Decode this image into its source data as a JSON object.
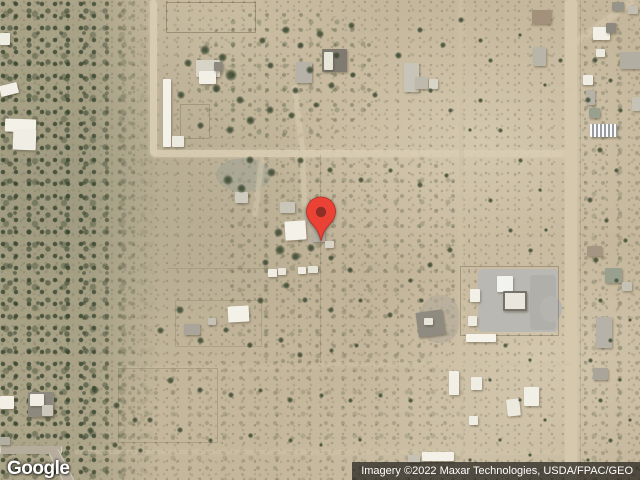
{
  "watermark": {
    "logo_text": "Google"
  },
  "attribution": {
    "text": "Imagery ©2022 Maxar Technologies, USDA/FPAC/GEO",
    "bar_color": "rgba(0,0,0,0.60)",
    "text_color": "#ffffff"
  },
  "pin": {
    "color": "#EA4335",
    "inner_color": "#8E2F27"
  },
  "map": {
    "base_color": "#c5b79c",
    "road_color": "#d9cdb3",
    "pads": [
      {
        "x": 478,
        "y": 269,
        "w": 80,
        "h": 63,
        "c": "#b9b8b2",
        "rad": "4px"
      },
      {
        "x": 530,
        "y": 275,
        "w": 26,
        "h": 55,
        "c": "#b0afa9",
        "rad": "4px"
      },
      {
        "x": 540,
        "y": 296,
        "w": 22,
        "h": 26,
        "c": "#b5b4ae",
        "rad": "50%"
      },
      {
        "x": 300,
        "y": 210,
        "w": 26,
        "h": 34,
        "c": "#bdb3a2",
        "rad": "40%",
        "o": 0.8
      },
      {
        "x": 216,
        "y": 158,
        "w": 55,
        "h": 34,
        "c": "#9aa093",
        "rad": "50%",
        "o": 0.5
      },
      {
        "x": 420,
        "y": 295,
        "w": 40,
        "h": 48,
        "c": "#b0a899",
        "rad": "45%",
        "o": 0.6
      }
    ],
    "roads": [
      {
        "x": 150,
        "y": 0,
        "w": 7,
        "h": 155,
        "c": "#d9cdb3",
        "o": 0.95
      },
      {
        "x": 152,
        "y": 150,
        "w": 422,
        "h": 7,
        "c": "#d9cdb3",
        "o": 0.9
      },
      {
        "x": 565,
        "y": 0,
        "w": 12,
        "h": 480,
        "c": "#d5c8ad"
      },
      {
        "x": 459,
        "y": 0,
        "w": 5,
        "h": 480,
        "c": "#cfc2a6",
        "o": 0.55
      },
      {
        "x": 75,
        "y": 450,
        "w": 495,
        "h": 4,
        "c": "#d2c6ab",
        "o": 0.45
      },
      {
        "x": 320,
        "y": 362,
        "w": 252,
        "h": 4,
        "c": "#cfc3a8",
        "o": 0.5
      },
      {
        "x": 120,
        "y": 366,
        "w": 200,
        "h": 3,
        "c": "#cfc3a8",
        "o": 0.3
      },
      {
        "x": 296,
        "y": 84,
        "w": 5,
        "h": 68,
        "c": "#d6cab0",
        "o": 0.7,
        "r": -7
      },
      {
        "x": 301,
        "y": 152,
        "w": 5,
        "h": 55,
        "c": "#d6cab0",
        "o": 0.6,
        "r": -3
      },
      {
        "x": 256,
        "y": 157,
        "w": 5,
        "h": 60,
        "c": "#d4c8ae",
        "o": 0.55,
        "r": 7
      },
      {
        "x": 601,
        "y": -14,
        "w": 6,
        "h": 72,
        "c": "#d6cab0",
        "o": 0.6,
        "r": 54
      },
      {
        "x": 460,
        "y": 88,
        "w": 114,
        "h": 3,
        "c": "#cfc3a8",
        "o": 0.25
      }
    ],
    "streets": [
      {
        "x": 0,
        "y": 446,
        "w": 60,
        "h": 8,
        "c": "#b5ac9c"
      },
      {
        "x": 56,
        "y": 449,
        "w": 9,
        "h": 36,
        "c": "#b5ac9c",
        "r": -27
      }
    ],
    "fences": [
      {
        "t": "box",
        "x": 166,
        "y": 2,
        "w": 88,
        "h": 29,
        "o": 0.5
      },
      {
        "t": "box",
        "x": 460,
        "y": 266,
        "w": 97,
        "h": 68,
        "o": 0.45
      },
      {
        "t": "box",
        "x": 118,
        "y": 368,
        "w": 98,
        "h": 73,
        "o": 0.3
      },
      {
        "t": "box",
        "x": 180,
        "y": 104,
        "w": 28,
        "h": 33,
        "o": 0.35
      },
      {
        "t": "box",
        "x": 175,
        "y": 300,
        "w": 85,
        "h": 45,
        "o": 0.25
      },
      {
        "t": "line",
        "x": 320,
        "y": 155,
        "w": 1,
        "h": 208,
        "o": 0.25
      },
      {
        "t": "line",
        "x": 167,
        "y": 268,
        "w": 100,
        "h": 1,
        "o": 0.22
      },
      {
        "t": "line",
        "x": 580,
        "y": 0,
        "w": 1,
        "h": 480,
        "o": 0.18
      }
    ],
    "buildings": [
      {
        "x": 0,
        "y": 33,
        "w": 10,
        "h": 12,
        "c": "#efece2"
      },
      {
        "x": 0,
        "y": 84,
        "w": 18,
        "h": 11,
        "c": "#f2efe6",
        "r": -14
      },
      {
        "x": 5,
        "y": 119,
        "w": 31,
        "h": 13,
        "c": "#f4f1e8",
        "r": 2
      },
      {
        "x": 13,
        "y": 130,
        "w": 23,
        "h": 20,
        "c": "#f0ede4",
        "r": 2
      },
      {
        "x": 163,
        "y": 79,
        "w": 8,
        "h": 68,
        "c": "#f4f1e8"
      },
      {
        "x": 172,
        "y": 136,
        "w": 12,
        "h": 11,
        "c": "#eceade"
      },
      {
        "x": 196,
        "y": 60,
        "w": 24,
        "h": 17,
        "c": "#d7d3c7"
      },
      {
        "x": 199,
        "y": 71,
        "w": 17,
        "h": 13,
        "c": "#f2efe6"
      },
      {
        "x": 214,
        "y": 62,
        "w": 9,
        "h": 9,
        "c": "#8d897f"
      },
      {
        "x": 296,
        "y": 62,
        "w": 16,
        "h": 21,
        "c": "#b6b2a8"
      },
      {
        "x": 322,
        "y": 49,
        "w": 25,
        "h": 23,
        "c": "#7f7b71"
      },
      {
        "x": 324,
        "y": 52,
        "w": 9,
        "h": 18,
        "c": "#e8e5da"
      },
      {
        "x": 404,
        "y": 63,
        "w": 15,
        "h": 29,
        "c": "#c9c4b8"
      },
      {
        "x": 415,
        "y": 77,
        "w": 13,
        "h": 12,
        "c": "#beb9ad"
      },
      {
        "x": 429,
        "y": 79,
        "w": 9,
        "h": 10,
        "c": "#d8d4c8"
      },
      {
        "x": 533,
        "y": 47,
        "w": 13,
        "h": 19,
        "c": "#bab5a9"
      },
      {
        "x": 532,
        "y": 10,
        "w": 19,
        "h": 14,
        "c": "#a3917b"
      },
      {
        "x": 593,
        "y": 27,
        "w": 17,
        "h": 13,
        "c": "#f2efe6"
      },
      {
        "x": 606,
        "y": 23,
        "w": 10,
        "h": 10,
        "c": "#8d897f"
      },
      {
        "x": 596,
        "y": 49,
        "w": 9,
        "h": 8,
        "c": "#eceadf"
      },
      {
        "x": 583,
        "y": 75,
        "w": 10,
        "h": 10,
        "c": "#f0ede4"
      },
      {
        "x": 586,
        "y": 90,
        "w": 9,
        "h": 15,
        "c": "#b6b2a8"
      },
      {
        "x": 589,
        "y": 108,
        "w": 11,
        "h": 10,
        "c": "#9aa08e"
      },
      {
        "x": 590,
        "y": 124,
        "w": 27,
        "h": 13,
        "c": "#c9ccce",
        "s": true
      },
      {
        "x": 620,
        "y": 52,
        "w": 20,
        "h": 17,
        "c": "#b2aea2"
      },
      {
        "x": 632,
        "y": 97,
        "w": 8,
        "h": 14,
        "c": "#c6c1b5"
      },
      {
        "x": 612,
        "y": 2,
        "w": 12,
        "h": 9,
        "c": "#99948a"
      },
      {
        "x": 628,
        "y": 6,
        "w": 10,
        "h": 8,
        "c": "#c3beb2"
      },
      {
        "x": 235,
        "y": 192,
        "w": 13,
        "h": 11,
        "c": "#cfcbbf"
      },
      {
        "x": 280,
        "y": 202,
        "w": 15,
        "h": 11,
        "c": "#c9c5b9"
      },
      {
        "x": 285,
        "y": 221,
        "w": 21,
        "h": 19,
        "c": "#f4f1e8",
        "r": -4
      },
      {
        "x": 312,
        "y": 231,
        "w": 13,
        "h": 11,
        "c": "#b3afa3"
      },
      {
        "x": 325,
        "y": 241,
        "w": 9,
        "h": 7,
        "c": "#d8d4c8"
      },
      {
        "x": 268,
        "y": 269,
        "w": 9,
        "h": 8,
        "c": "#f0ede4"
      },
      {
        "x": 278,
        "y": 268,
        "w": 8,
        "h": 7,
        "c": "#eae7dc"
      },
      {
        "x": 298,
        "y": 267,
        "w": 8,
        "h": 7,
        "c": "#f0ede4"
      },
      {
        "x": 308,
        "y": 266,
        "w": 10,
        "h": 7,
        "c": "#e6e3d8"
      },
      {
        "x": 228,
        "y": 306,
        "w": 21,
        "h": 16,
        "c": "#f4f1e8",
        "r": -3
      },
      {
        "x": 184,
        "y": 324,
        "w": 16,
        "h": 11,
        "c": "#a9a59b"
      },
      {
        "x": 208,
        "y": 318,
        "w": 8,
        "h": 7,
        "c": "#c5c1b5"
      },
      {
        "x": 497,
        "y": 276,
        "w": 16,
        "h": 16,
        "c": "#f2f2ee"
      },
      {
        "x": 503,
        "y": 291,
        "w": 20,
        "h": 16,
        "c": "#e9e7dd",
        "b": "2px solid #76726a"
      },
      {
        "x": 470,
        "y": 289,
        "w": 10,
        "h": 13,
        "c": "#f2efe6"
      },
      {
        "x": 468,
        "y": 316,
        "w": 9,
        "h": 10,
        "c": "#eeebe1"
      },
      {
        "x": 466,
        "y": 334,
        "w": 30,
        "h": 8,
        "c": "#f6f3ea"
      },
      {
        "x": 417,
        "y": 311,
        "w": 27,
        "h": 25,
        "c": "#8f8b81",
        "r": -8
      },
      {
        "x": 424,
        "y": 318,
        "w": 9,
        "h": 7,
        "c": "#e8e5da"
      },
      {
        "x": 449,
        "y": 371,
        "w": 10,
        "h": 24,
        "c": "#f2efe6"
      },
      {
        "x": 471,
        "y": 377,
        "w": 11,
        "h": 13,
        "c": "#f0ede4"
      },
      {
        "x": 524,
        "y": 387,
        "w": 15,
        "h": 19,
        "c": "#f2efe6"
      },
      {
        "x": 507,
        "y": 399,
        "w": 13,
        "h": 17,
        "c": "#eceade",
        "r": -6
      },
      {
        "x": 469,
        "y": 416,
        "w": 9,
        "h": 9,
        "c": "#f0ede4"
      },
      {
        "x": 422,
        "y": 452,
        "w": 32,
        "h": 9,
        "c": "#f4f1e8"
      },
      {
        "x": 408,
        "y": 455,
        "w": 12,
        "h": 8,
        "c": "#c5c1b5"
      },
      {
        "x": 596,
        "y": 317,
        "w": 16,
        "h": 31,
        "c": "#b6b2a8"
      },
      {
        "x": 593,
        "y": 368,
        "w": 15,
        "h": 12,
        "c": "#a9a59b"
      },
      {
        "x": 587,
        "y": 246,
        "w": 15,
        "h": 10,
        "c": "#a49682"
      },
      {
        "x": 605,
        "y": 268,
        "w": 17,
        "h": 15,
        "c": "#9aa08e"
      },
      {
        "x": 622,
        "y": 282,
        "w": 10,
        "h": 9,
        "c": "#c6c1b5"
      },
      {
        "x": 0,
        "y": 396,
        "w": 14,
        "h": 13,
        "c": "#f2efe6"
      },
      {
        "x": 28,
        "y": 392,
        "w": 26,
        "h": 25,
        "c": "#8d897f"
      },
      {
        "x": 30,
        "y": 394,
        "w": 14,
        "h": 12,
        "c": "#f0ede4"
      },
      {
        "x": 42,
        "y": 405,
        "w": 11,
        "h": 11,
        "c": "#cbc7bb"
      },
      {
        "x": 0,
        "y": 437,
        "w": 10,
        "h": 8,
        "c": "#b2aea2"
      }
    ],
    "trees": [
      [
        205,
        50,
        10
      ],
      [
        188,
        63,
        8
      ],
      [
        222,
        57,
        9
      ],
      [
        231,
        75,
        12
      ],
      [
        216,
        88,
        9
      ],
      [
        181,
        95,
        8
      ],
      [
        240,
        100,
        8
      ],
      [
        262,
        40,
        7
      ],
      [
        286,
        30,
        8
      ],
      [
        300,
        45,
        7
      ],
      [
        320,
        34,
        8
      ],
      [
        336,
        55,
        7
      ],
      [
        351,
        25,
        7
      ],
      [
        270,
        65,
        7
      ],
      [
        310,
        70,
        8
      ],
      [
        295,
        90,
        7
      ],
      [
        331,
        85,
        7
      ],
      [
        353,
        75,
        6
      ],
      [
        375,
        95,
        6
      ],
      [
        398,
        55,
        7
      ],
      [
        420,
        30,
        6
      ],
      [
        443,
        45,
        6
      ],
      [
        461,
        20,
        6
      ],
      [
        480,
        40,
        5
      ],
      [
        270,
        110,
        8
      ],
      [
        250,
        120,
        9
      ],
      [
        291,
        115,
        7
      ],
      [
        316,
        105,
        6
      ],
      [
        230,
        130,
        8
      ],
      [
        200,
        125,
        7
      ],
      [
        250,
        160,
        8
      ],
      [
        271,
        172,
        9
      ],
      [
        228,
        180,
        10
      ],
      [
        241,
        188,
        9
      ],
      [
        300,
        160,
        7
      ],
      [
        330,
        170,
        6
      ],
      [
        361,
        180,
        6
      ],
      [
        390,
        170,
        5
      ],
      [
        420,
        185,
        6
      ],
      [
        446,
        175,
        5
      ],
      [
        278,
        232,
        9
      ],
      [
        280,
        250,
        10
      ],
      [
        295,
        256,
        9
      ],
      [
        311,
        248,
        8
      ],
      [
        265,
        262,
        7
      ],
      [
        331,
        258,
        6
      ],
      [
        350,
        270,
        6
      ],
      [
        286,
        285,
        7
      ],
      [
        260,
        300,
        7
      ],
      [
        305,
        300,
        6
      ],
      [
        331,
        310,
        6
      ],
      [
        360,
        300,
        5
      ],
      [
        390,
        315,
        6
      ],
      [
        421,
        300,
        5
      ],
      [
        180,
        310,
        8
      ],
      [
        160,
        330,
        7
      ],
      [
        200,
        340,
        7
      ],
      [
        226,
        330,
        6
      ],
      [
        250,
        345,
        6
      ],
      [
        281,
        340,
        6
      ],
      [
        300,
        355,
        6
      ],
      [
        331,
        350,
        5
      ],
      [
        356,
        345,
        5
      ],
      [
        170,
        380,
        7
      ],
      [
        200,
        390,
        6
      ],
      [
        231,
        395,
        6
      ],
      [
        260,
        390,
        5
      ],
      [
        290,
        400,
        6
      ],
      [
        321,
        395,
        5
      ],
      [
        350,
        400,
        5
      ],
      [
        380,
        395,
        5
      ],
      [
        410,
        400,
        5
      ],
      [
        150,
        420,
        6
      ],
      [
        180,
        430,
        6
      ],
      [
        210,
        440,
        5
      ],
      [
        250,
        435,
        5
      ],
      [
        290,
        440,
        5
      ],
      [
        321,
        445,
        4
      ],
      [
        360,
        440,
        4
      ],
      [
        95,
        390,
        8
      ],
      [
        116,
        405,
        7
      ],
      [
        135,
        420,
        6
      ],
      [
        90,
        430,
        7
      ],
      [
        115,
        445,
        6
      ],
      [
        140,
        450,
        5
      ],
      [
        480,
        100,
        5
      ],
      [
        500,
        130,
        5
      ],
      [
        520,
        160,
        5
      ],
      [
        540,
        190,
        4
      ],
      [
        490,
        200,
        5
      ],
      [
        510,
        230,
        5
      ],
      [
        470,
        130,
        4
      ],
      [
        450,
        110,
        5
      ],
      [
        430,
        90,
        5
      ],
      [
        595,
        60,
        6
      ],
      [
        610,
        80,
        5
      ],
      [
        588,
        100,
        6
      ],
      [
        620,
        110,
        5
      ],
      [
        600,
        150,
        6
      ],
      [
        616,
        170,
        5
      ],
      [
        590,
        200,
        6
      ],
      [
        606,
        220,
        5
      ],
      [
        625,
        240,
        5
      ],
      [
        596,
        260,
        6
      ],
      [
        616,
        280,
        5
      ],
      [
        600,
        300,
        5
      ],
      [
        630,
        320,
        4
      ],
      [
        610,
        340,
        5
      ],
      [
        590,
        360,
        5
      ],
      [
        620,
        380,
        4
      ],
      [
        600,
        400,
        5
      ],
      [
        630,
        420,
        4
      ],
      [
        610,
        440,
        5
      ],
      [
        588,
        460,
        4
      ],
      [
        450,
        250,
        6
      ],
      [
        430,
        265,
        6
      ],
      [
        410,
        280,
        5
      ],
      [
        530,
        250,
        5
      ],
      [
        546,
        230,
        4
      ],
      [
        505,
        345,
        5
      ],
      [
        530,
        360,
        4
      ],
      [
        490,
        380,
        4
      ],
      [
        520,
        400,
        4
      ],
      [
        545,
        420,
        4
      ],
      [
        500,
        440,
        4
      ],
      [
        470,
        460,
        4
      ],
      [
        530,
        455,
        4
      ],
      [
        560,
        60,
        5
      ],
      [
        545,
        85,
        4
      ],
      [
        490,
        60,
        5
      ],
      [
        520,
        35,
        4
      ]
    ]
  }
}
